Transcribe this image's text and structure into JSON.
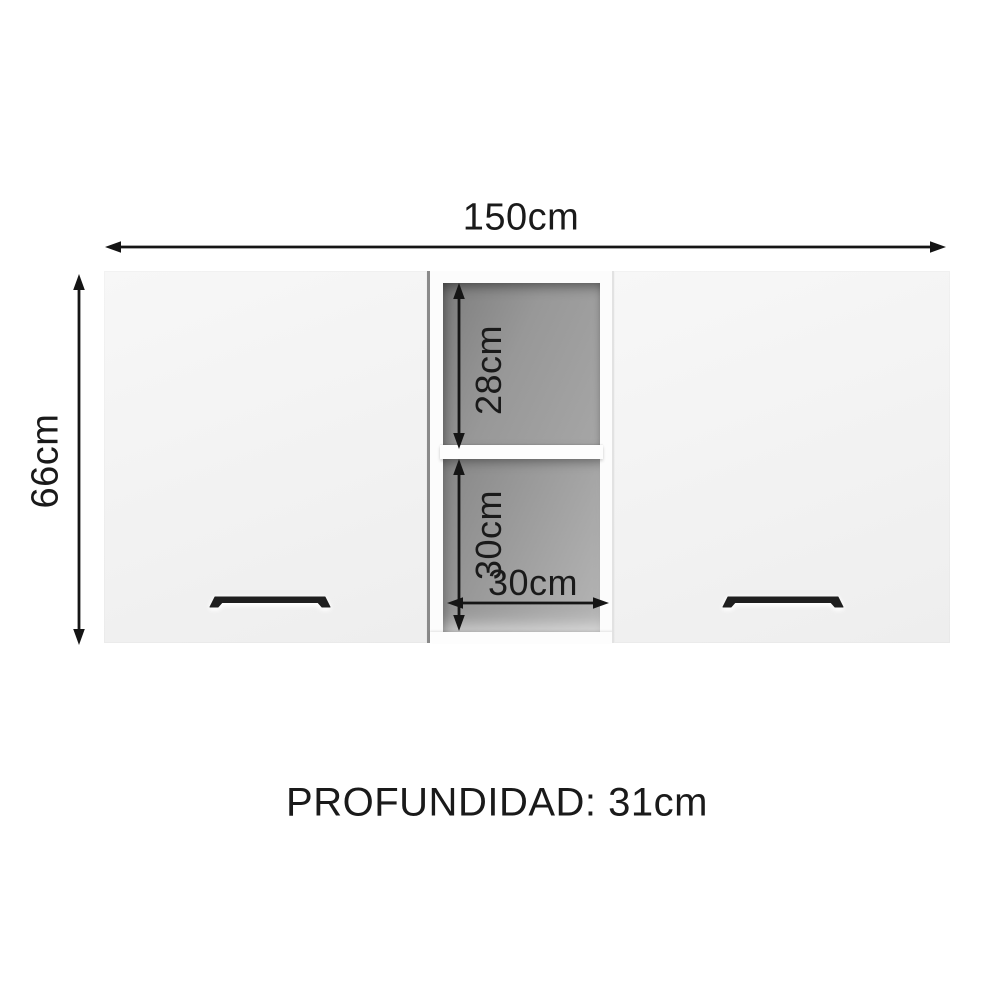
{
  "labels": {
    "overall_width": "150cm",
    "overall_height": "66cm",
    "upper_compartment_height": "28cm",
    "lower_compartment_height": "30cm",
    "compartment_width": "30cm",
    "depth": "PROFUNDIDAD: 31cm"
  },
  "colors": {
    "background": "#ffffff",
    "text": "#1a1a1a",
    "arrow": "#151515",
    "door_light": "#f7f7f7",
    "door_dark": "#eeeeee",
    "gap_dark": "#8a8a8a",
    "gap_light": "#e2e2e2",
    "niche_frame": "#fcfcfc",
    "niche_dark": "#7e7e7e",
    "niche_mid": "#989898",
    "niche_light": "#b5b5b5",
    "shelf": "#fdfdfd",
    "handle": "#1f1f1f"
  }
}
